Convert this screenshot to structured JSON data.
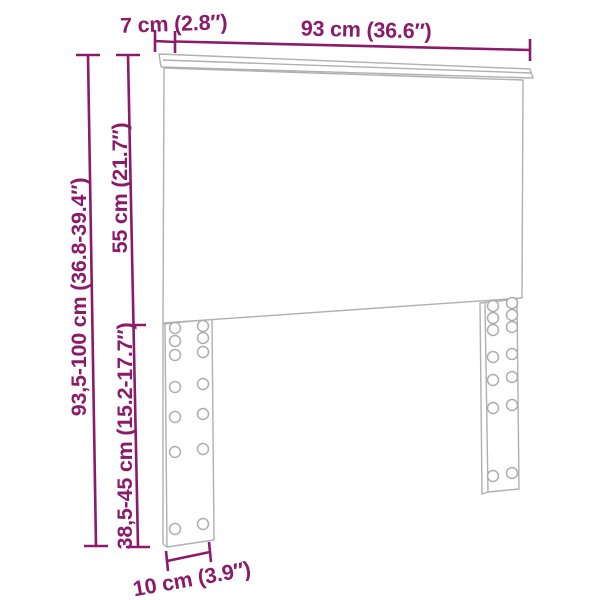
{
  "diagram": {
    "type": "product-dimension-diagram",
    "subject": "headboard line drawing with bolt holes in two legs",
    "colors": {
      "dimension_accent": "#8b1a6a",
      "drawing_lines": "#b0b0b0",
      "background": "#ffffff"
    },
    "labels": {
      "cap_thickness": "7 cm (2.8″)",
      "width": "93 cm (36.6″)",
      "panel_height": "55 cm (21.7″)",
      "total_height": "93,5-100 cm (36.8-39.4″)",
      "leg_height": "38,5-45 cm (15.2-17.7″)",
      "leg_width": "10 cm (3.9″)"
    }
  }
}
